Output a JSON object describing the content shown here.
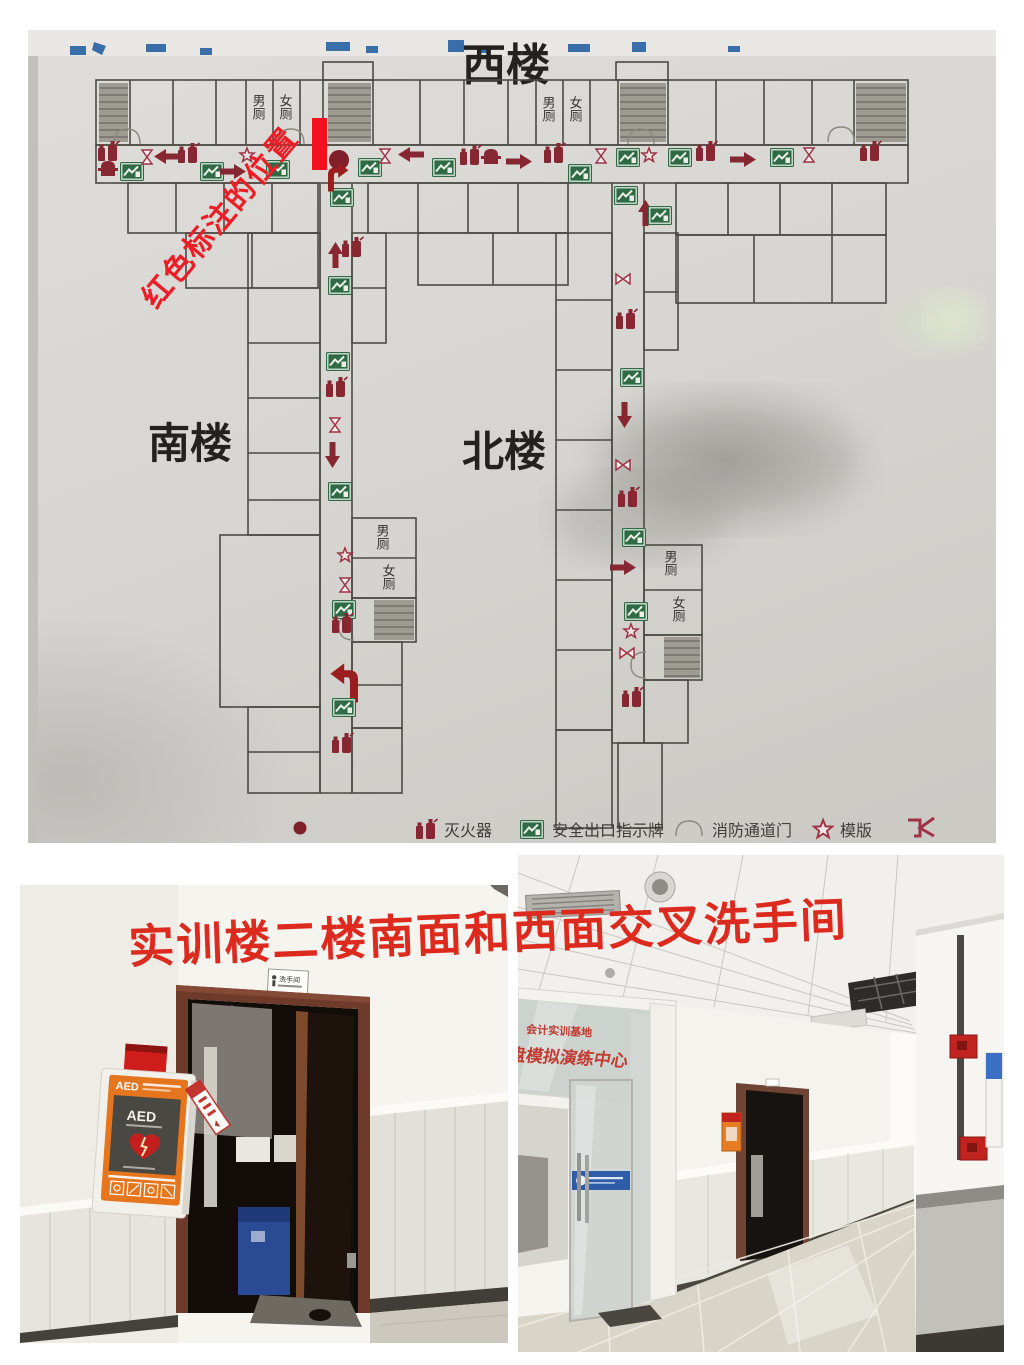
{
  "floor_plan": {
    "title": "西楼",
    "south_label": "南楼",
    "north_label": "北楼",
    "men_toilet": "男厕",
    "women_toilet": "女厕",
    "annotation_text": "红色标注的位置",
    "annotation_color": "#ee1c25",
    "marker_color": "#f2111c",
    "icon_red": "#872732",
    "icon_green": "#2e6b45",
    "legend": {
      "extinguisher": "灭火器",
      "exit_sign": "安全出口指示牌",
      "fire_door": "消防通道门",
      "star": "模版"
    }
  },
  "caption": {
    "text": "实训楼二楼南面和西面交叉洗手间",
    "color": "#dd2a1e"
  },
  "photo_left": {
    "door_sign": "洗手间",
    "aed_label": "AED",
    "aed_device_label": "AED"
  },
  "photo_right": {
    "glass_line1": "会计实训基地",
    "glass_line2": "沙盘模拟演练中心",
    "glass_text_color": "#c23a30"
  }
}
